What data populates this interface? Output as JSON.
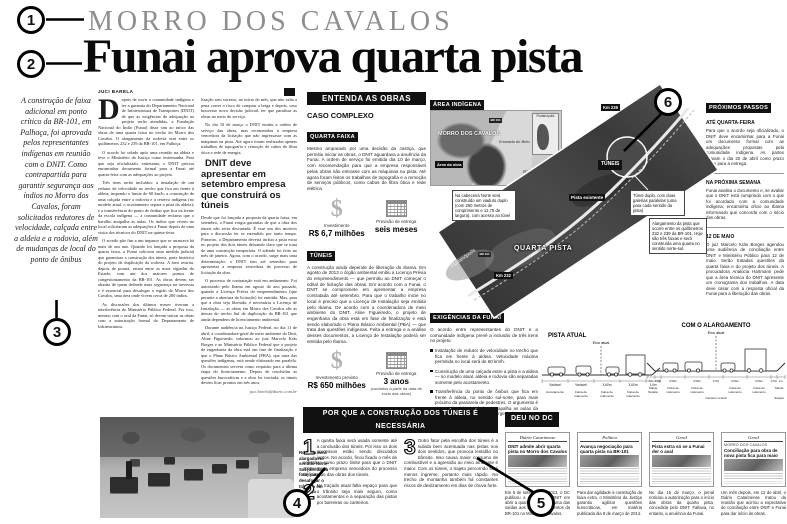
{
  "annotations": {
    "m1": "1",
    "m2": "2",
    "m3": "3",
    "m4": "4",
    "m5": "5",
    "m6": "6"
  },
  "header": {
    "kicker": "MORRO DOS CAVALOS",
    "headline": "Funai aprova quarta pista"
  },
  "lede": "A construção de faixa adicional em ponto crítico da BR-101, em Palhoça, foi aprovada pelos representantes indígenas em reunião com o DNIT. Como contrapartida para garantir segurança aos índios no Morro dos Cavalos, foram solicitados redutores de velocidade, calçada entre a aldeia e a rodovia, além de mudanças de local do ponto de ônibus",
  "article": {
    "byline": "JUCI BARELA",
    "dropcap": "D",
    "col1": [
      "epois de ouvir a comunidade indígena e ter a garantia do Departamento Nacional de Infraestrutura de Transportes (DNIT) de que as exigências de adequação ao projeto serão atendidas, a Fundação Nacional do Índio (Funai) disse sim ao início das obras de uma quarta faixa no trecho do Morro dos Cavalos. O alargamento da rodovia será entre os quilômetros 232 e 239 da BR-101, em Palhoça.",
      "O acordo foi selado após uma reunião na aldeia e teve o Ministério da Justiça como testemunha. Para que seja oficializado, entretanto, o DNIT precisa encaminhar documento formal para a Funai até quarta-feira com as adequações ao projeto.",
      "Três itens serão incluídos: a instalação de um redutor de velocidade no trecho que fica em frente à aldeia, impondo o limite de 60 km/h; a construção de uma calçada entre a rodovia e a reserva indígena (no modelo atual, o acostamento separa a pista da aldeia); e a transferência do ponto de ônibus que fica na frente da escola indígena — a comunidade reclama que o barulho atrapalha as aulas. Os índios que vivem no local solicitaram as adequações à Funai depois de uma visita dos técnicos do DNIT na quinta-feira.",
      "O acordo põe fim a um impasse que se arrastava há mais de um ano. Quando foi lançada a proposta da quarta faixa, a Funai solicitou uma medida judicial que garantisse a construção dos túneis, parte histórica do projeto de duplicação da rodovia. A área restrita, depois de pronta, estará entre as mais vigiadas do Estado, com um dos maiores pontos de congestionamento da BR-101. As obras devem ser aliadas de quem defende mais segurança na travessia e é essencial para desafogar a região do Morro dos Cavalos, uma área onde vivem cerca de 200 índios.",
      "As discussões dos últimos meses tiveram a interferência do Ministério Público Federal. Por isso, mesmo com o aval da Funai, só devem iniciar as obras com a autorização formal do Departamento de Infraestrutura."
    ],
    "col2a": [
      "lização sem sucesso, no início do mês, que não valia a pena correr o risco de comprar a briga e depois, caso houvesse nova decisão judicial, ter que paralisar as obras no meio do serviço.",
      "No dia 10 de março o DNIT emitiu a ordem de serviço das obras, mas recomendou à empresa vencedora da licitação que não ingressasse com as máquinas na pista. Até agora foram realizados apenas trabalhos de topografia e remoção de cabos de fibra ótica e rede de energia."
    ],
    "subhead": "DNIT deve apresentar em setembro empresa que construirá os túneis",
    "col2b": [
      "Desde que foi lançada a proposta da quarta faixa, em setembro, a Funai exigia garantias de que a obra dos túneis não seria descartada. É esse um dos motivos para a discussão ter se estendido por tanto tempo. Primeiro, o Departamento deveria incluir a pista extra no projeto dos dois túneis deixando claro que se trata de uma construção temporária. O adendo foi feito no mês de janeiro. Agora, com o acordo, surge mais uma determinação: o DNIT tem até setembro para apresentar a empresa vencedora do processo de licitação da obra.",
      "O processo de contratação está em andamento. Foi autorizado pelo Ibama em agosto do ano passado, quando a Licença Prévia do empreendimento (que permite a abertura de licitação) foi emitida. Mas, para que a obra seja liberada, é necessária a Licença de Instalação — as obras em Morro dos Cavalos são as únicas do trecho Sul de duplicação da BR-101 que ainda dependem de licenciamento ambiental.",
      "Durante audiência na Justiça Federal, no dia 11 de abril, a coordenadora-geral de meio ambiente do Dnit, Aline Figueiredo, informou ao juiz Marcelo Krás Borges e ao Ministério Público Federal que o projeto de engenharia da obra está em fase de finalização e que o Plano Básico Ambiental (PBA), que trata das questões indígenas, está sendo elaborado em paralelo. Os documentos servem como requisito para a última etapa do licenciamento. Depois de resolvidas as questões burocráticas e a obra for iniciada, os túneis devem ficar prontos em três anos."
    ],
    "credit": "juci.barela@diario.com.br"
  },
  "photo": {
    "caption": "Rodovia será alargada no sentido Norte-Sul (direita da foto) para desafogar o trânsito em Palhoça"
  },
  "entenda": {
    "title": "ENTENDA AS OBRAS",
    "caso": "CASO COMPLEXO",
    "quarta": {
      "tag": "QUARTA FAIXA",
      "text": "Mesmo amparado por uma decisão da Justiça, que permitiu iniciar as obras, o DNIT aguardava a anuência da Funai. A ordem de serviço foi emitida dia 10 de março, com recomendação para que a empresa responsável pelas obras não entrasse com as máquinas na pista. Até agora foram feitos os trabalhos de topografia e a remoção de serviços públicos, como cabos de fibra ótica e rede elétrica.",
      "inv_label": "Investimento",
      "inv_value": "R$ 6,7 milhões",
      "ent_label": "Previsão de entrega",
      "ent_value": "seis meses"
    },
    "tuneis": {
      "tag": "TÚNEIS",
      "text": "A construção ainda depende de liberação do Ibama. Em agosto de 2013 o órgão ambiental emitiu a Licença Prévia do empreendimento — que permitiu ao DNIT começar o edital de licitação das obras. Em acordo com a Funai, o DNIT se compromete em apresentar a empresa contratada até setembro. Para que o trabalho inicie no local é preciso que a Licença de Instalação seja emitida pelo Ibama. De acordo com a coordenadora de meio ambiente do DNIT, Aline Figueiredo, o projeto de engenharia da obra está em fase de finalização e está sendo elaborado o Plano Básico Ambiental (PBA) — que trata das questões indígenas. Feita a entrega e a análise desses documentos, a Licença de Instalação poderá ser emitida pelo Ibama.",
      "inv_label": "Investimento previsto",
      "inv_value": "R$ 650 milhões",
      "ent_label": "Previsão de entrega",
      "ent_value": "3 anos",
      "ent_note": "(contados a partir da data de início das obras)"
    }
  },
  "mapbox": {
    "tag": "ÁREA INDÍGENA",
    "title": "MORRO DOS CAVALOS",
    "obra": "Área da obra",
    "enseada": "Enseada do Brito",
    "baia": "Baía Sul",
    "shield": "BR 101",
    "inset": "Florianópolis"
  },
  "aerial": {
    "direction": "Florianópolis",
    "km_top": "Km 239",
    "km_bottom": "Km 232",
    "shield": "BR 101",
    "tuneis": "TÚNEIS",
    "pista": "Pista existente",
    "quarta": "QUARTA PISTA",
    "callout_viaduto": "Na cabeceira Norte será construído um viaduto duplo (com 260 metros de comprimento e 12,75 de largura), com acesso ao túnel",
    "callout_tunel": "Túnel duplo, com duas galerias paralelas (uma para cada sentido da pista)",
    "callout_alarg": "Alargamento da pista que ocorre entre os quilômetros 232 e 239 da BR-101. Hoje são três faixas e será construída uma quarta no sentido norte-sul."
  },
  "exigencias": {
    "tag": "EXIGÊNCIAS DA FUNAI",
    "intro": "O acordo entre representantes do DNIT e a comunidade indígena prevê a inclusão de três itens no projeto:",
    "items": [
      "Instalação de redutor de velocidade no trecho que fica em frente à aldeia. Velocidade máxima permitida no local será de 60 km/h.",
      "Construção de uma calçada entre a pista e a aldeia — no modelo atual, aldeia e rodovia são separadas somente pelo acostamento.",
      "Transferência do ponto de ônibus que fica em frente à aldeia, no sentido sul-norte, para mais próximo da passarela de pedestres. O argumento é de que o ruído dos ônibus atrapalha as aulas da escola indígena, que fica às margens da rodovia."
    ]
  },
  "diagrams": {
    "atual": {
      "title": "PISTA ATUAL",
      "axis": "Eixo atual",
      "dims": [
        "Variável",
        "Variável",
        "3,60m",
        "3,60m",
        "1,0m"
      ],
      "labels": [
        [
          "Acostamento"
        ],
        [
          "Faixa de",
          "rolamento"
        ],
        [
          "Faixa de",
          "rolamento"
        ],
        [
          "Faixa de",
          "rolamento"
        ],
        [
          "Sarjeta"
        ]
      ]
    },
    "alargamento": {
      "title": "COM O ALARGAMENTO",
      "axis": "Eixo atual",
      "dims": [
        "1m",
        "0,5m",
        "3,50m",
        "3,50m",
        "0,5m",
        "3,50m",
        "3,50m",
        "0,5m",
        "1m"
      ],
      "labels": [
        [
          "Talude"
        ],
        [
          "Faixa de",
          "rolamento"
        ],
        [
          "Faixa de",
          "rolamento"
        ],
        [
          "Faixa de",
          "rolamento"
        ],
        [
          "Faixa de",
          "rolamento"
        ],
        [
          "Talude"
        ]
      ],
      "note": "Canteiro central",
      "sarjeta": "Sarjeta"
    }
  },
  "proximos": {
    "tag": "PRÓXIMOS PASSOS",
    "sections": [
      {
        "head": "ATÉ QUARTA-FEIRA",
        "text": "Para que o acordo seja oficializado, o DNIT deve encaminhar para a Funai um documento formal com as adequações propostas pela comunidade indígena. As partes fixaram o dia 20 de abril como prazo limite para a entrega."
      },
      {
        "head": "NA PRÓXIMA SEMANA",
        "text": "Funai analisa o documento e, se avaliar que o DNIT está cumprindo com o que foi acordado com a comunidade indígena, encaminha ofício ao Ibama informando que concorda com o início das obras."
      },
      {
        "head": "12 DE MAIO",
        "text": "O juiz Marcelo Krás Borges agendou uma audiência de conciliação entre DNIT e Ministério Público para 12 de maio. Serão tratadas questões da quarta faixa e do projeto dos túneis. A procuradora Analúcia Hartmann pede que a área técnica do DNIT apresente um cronograma dos trabalhos. A data deve casar com a resposta oficial da Funai para a liberação das obras."
      }
    ]
  },
  "porque": {
    "title": "POR QUE A CONSTRUÇÃO DOS TÚNEIS É NECESSÁRIA",
    "items": [
      {
        "num": "1",
        "text": "A quarta faixa será usada somente até a conclusão dos túneis. Por isso os dois processos estão sendo discutidos juntos. No acordo, ficou fixado o mês de setembro como prazo limite para que o DNIT apresente a empresa vencedora do processo de licitação das obras dos túneis."
      },
      {
        "num": "2",
        "text": "No traçado atual falta espaço para que o trânsito seja mais seguro, como acostamentos e a separação das pistas por barreiras ou canteiros."
      },
      {
        "num": "3",
        "text": "Outro fator pela escolha dos túneis é a subida bem acentuada nas pistas nos dois sentidos, que provoca lentidão no trânsito. Isso causa maior consumo de combustível e a agressão ao meio ambiente é maior. Com os túneis, o trajeto percorrido será menos íngreme, portanto mais rápido. No trecho de montanha também há constantes riscos de deslizamento em dias de chuva forte."
      }
    ]
  },
  "deunodc": {
    "tag": "DEU NO DC",
    "clips": [
      {
        "masthead": "Diário Catarinense",
        "headline": "DNIT admite abrir quarta pista no Morro dos Cavalos",
        "caption": "Em 5 de setembro de 2013, o DC publicou a decisão do DNIT em abrir a quarta pista como uma das saídas aos congestionamentos da BR-101 no Morro dos Cavalos."
      },
      {
        "masthead": "Política",
        "headline": "Avança negociação para quarta pista na BR-101",
        "caption": "Para dar agilidade à construção da faixa extra, o Ministério da Justiça garantiu agilizar questões burocráticas, em matéria publicada dia 8 de março de 2014."
      },
      {
        "masthead": "Geral",
        "headline": "Pista extra só se a Funai der o aval",
        "caption": "No dia 15 de março, o jornal noticiou a autorização para o início das obras da quarta pista, concedida pelo DNIT. Faltava, no entanto, a anuência da Funai."
      },
      {
        "masthead": "Geral",
        "kicker": "MORRO DOS CAVALOS",
        "headline": "Conciliação para obra de nova pista fica para maio",
        "caption": "Um mês depois, em 12 de abril, o Diário Catarinense tratou da reunião que acirrou a expectativa de conciliação entre DNIT e Funai para dar início às obras."
      }
    ]
  }
}
